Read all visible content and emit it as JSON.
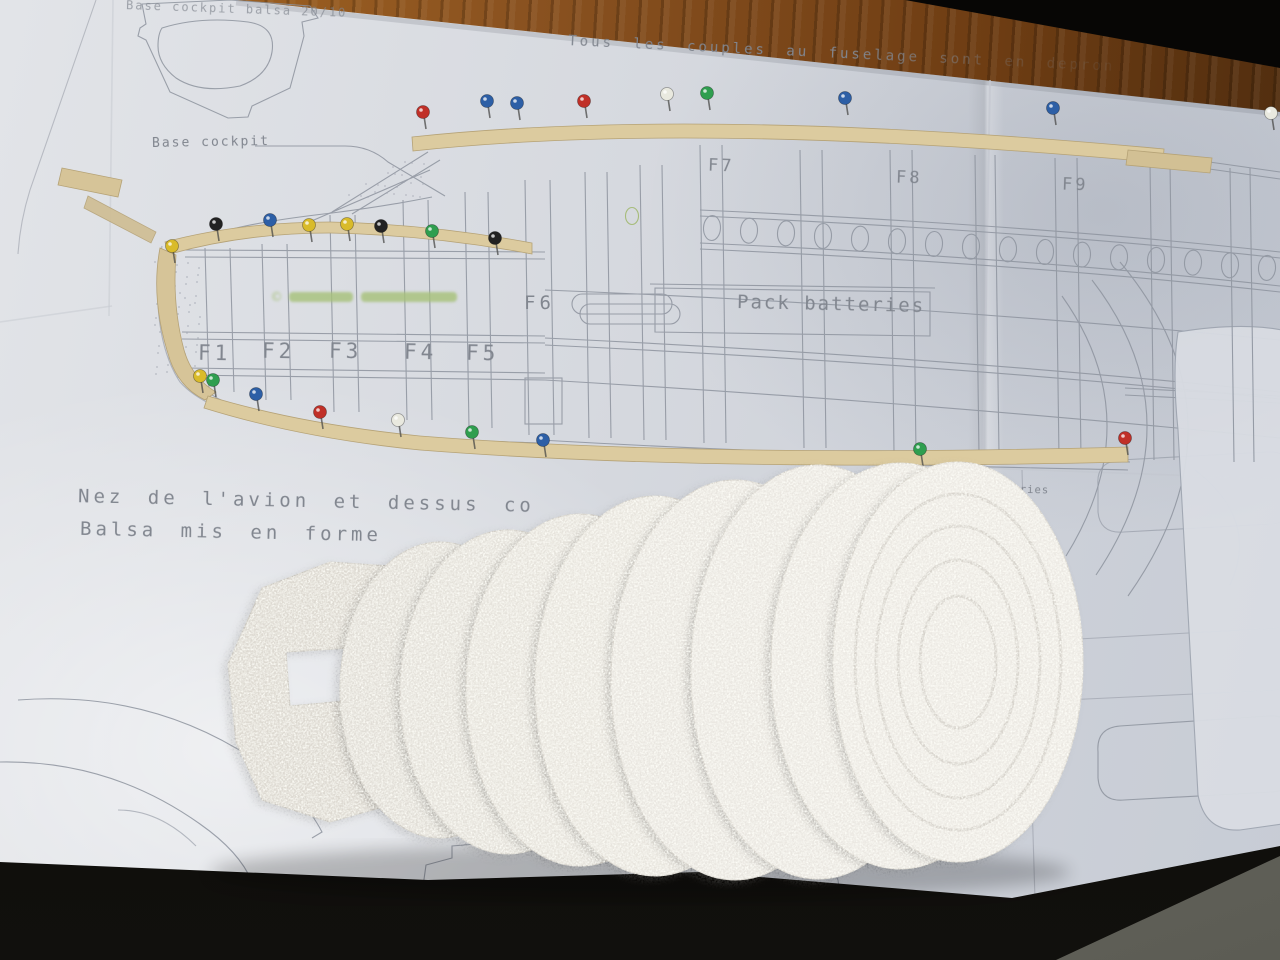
{
  "scene_colors": {
    "paper": "#d6d9df",
    "plan_line": "#8d939e",
    "plan_text": "#81868f",
    "wood_table": "#8a5220",
    "balsa_wood": "#d9c79c",
    "foam": "#e9e7e1",
    "floor_tile": "#6e6e66",
    "watermark_green": "#a6c178"
  },
  "plan": {
    "notes": {
      "top_note": "Tous les couples au fuselage sont en depron",
      "base_cockpit_sheet": "Base cockpit balsa 20/10",
      "base_cockpit": "Base cockpit",
      "pack_batteries": "Pack batteries",
      "nose_line1": "Nez de l'avion et dessus co",
      "nose_line2": "Balsa mis en forme",
      "batteries_note": "ls aux batteries",
      "watermark": "©"
    },
    "formers": [
      "F1",
      "F2",
      "F3",
      "F4",
      "F5",
      "F6",
      "F7",
      "F8",
      "F9"
    ],
    "partial_former": "F14"
  },
  "pins": {
    "colors": {
      "red": "#c03028",
      "blue": "#2d5fa6",
      "green": "#2f9e4f",
      "yellow": "#d9bb2a",
      "black": "#222222",
      "white": "#e9e9df"
    },
    "items": [
      [
        "red",
        423,
        112
      ],
      [
        "blue",
        487,
        101
      ],
      [
        "blue",
        517,
        103
      ],
      [
        "red",
        584,
        101
      ],
      [
        "white",
        667,
        94
      ],
      [
        "green",
        707,
        93
      ],
      [
        "blue",
        845,
        98
      ],
      [
        "blue",
        1053,
        108
      ],
      [
        "white",
        1271,
        113
      ],
      [
        "yellow",
        172,
        246
      ],
      [
        "black",
        216,
        224
      ],
      [
        "blue",
        270,
        220
      ],
      [
        "yellow",
        309,
        225
      ],
      [
        "yellow",
        347,
        224
      ],
      [
        "black",
        381,
        226
      ],
      [
        "green",
        432,
        231
      ],
      [
        "black",
        495,
        238
      ],
      [
        "yellow",
        200,
        376
      ],
      [
        "green",
        213,
        380
      ],
      [
        "blue",
        256,
        394
      ],
      [
        "red",
        320,
        412
      ],
      [
        "white",
        398,
        420
      ],
      [
        "green",
        472,
        432
      ],
      [
        "blue",
        543,
        440
      ],
      [
        "green",
        920,
        449
      ],
      [
        "red",
        1125,
        438
      ]
    ]
  }
}
